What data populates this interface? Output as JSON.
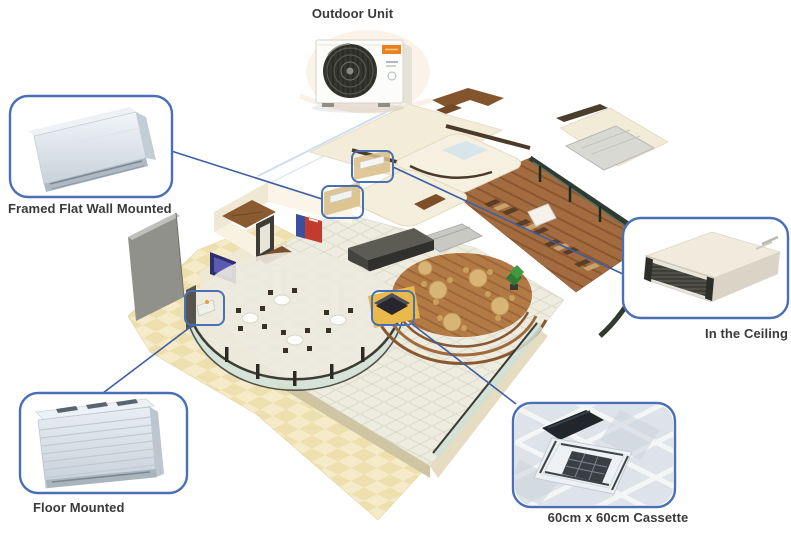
{
  "scene": "isometric-restaurant-floor-plan-with-air-conditioning-unit-placement",
  "callouts": [
    {
      "id": "outdoor-unit",
      "label": "Outdoor Unit",
      "image": "outdoor-condenser-unit",
      "has_bubble": false
    },
    {
      "id": "framed-flat-wall-mounted",
      "label": "Framed Flat Wall Mounted",
      "image": "wall-mounted-indoor-unit",
      "has_bubble": true
    },
    {
      "id": "in-the-ceiling",
      "label": "In the Ceiling",
      "image": "concealed-ceiling-duct-unit",
      "has_bubble": true
    },
    {
      "id": "floor-mounted",
      "label": "Floor Mounted",
      "image": "floor-standing-unit",
      "has_bubble": true
    },
    {
      "id": "cassette-60x60",
      "label": "60cm x 60cm Cassette",
      "image": "ceiling-cassette-unit",
      "has_bubble": true
    }
  ],
  "colors": {
    "background": "#ffffff",
    "callout_border": "#4a6fb5",
    "connector_line": "#3d5ea6",
    "highlight_marker": "#4a6fb5",
    "label_text": "#3a3a3a",
    "sand_patio": "#eedfae",
    "roof_cream": "#f3ecd9",
    "restaurant_wood": "#a26c40",
    "glass_wall": "#d3e2d8"
  }
}
